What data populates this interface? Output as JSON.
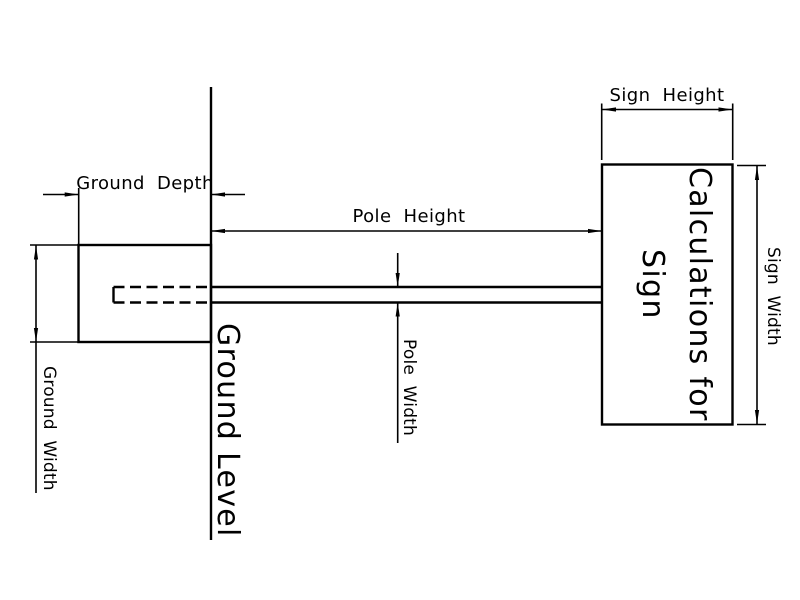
{
  "drawing": {
    "background_color": "#ffffff",
    "line_color": "#000000"
  },
  "labels": {
    "ground_depth": "Ground Depth",
    "pole_height": "Pole Height",
    "sign_height": "Sign Height",
    "ground_width": "Ground Width",
    "pole_width": "Pole Width",
    "sign_width": "Sign Width",
    "ground_level": "Ground Level",
    "sign_text_line1": "Calculations for",
    "sign_text_line2": "Sign"
  }
}
